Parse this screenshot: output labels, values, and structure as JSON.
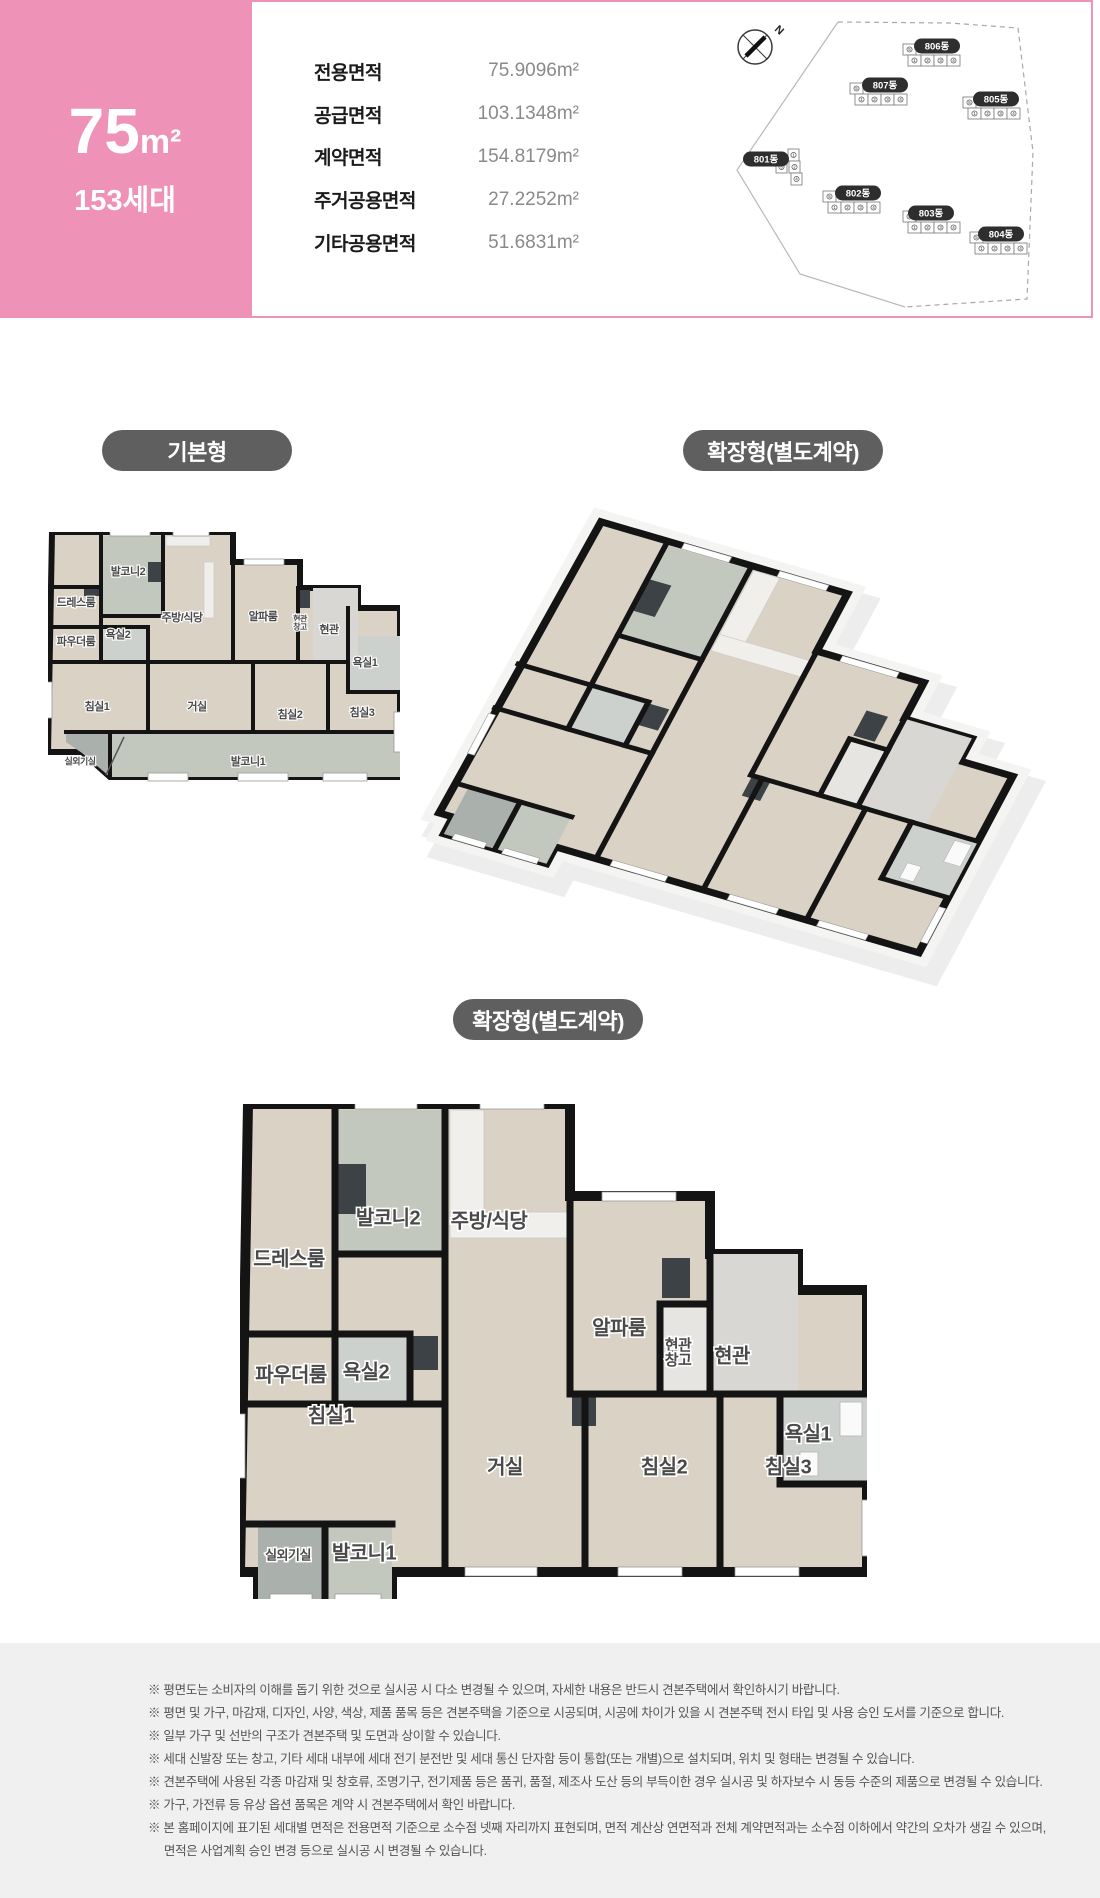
{
  "header": {
    "type_box": {
      "size": "75",
      "unit": "m²",
      "households": "153세대",
      "bg": "#ee92b8"
    },
    "area_table": {
      "rows": [
        {
          "label": "전용면적",
          "value": "75.9096m²"
        },
        {
          "label": "공급면적",
          "value": "103.1348m²"
        },
        {
          "label": "계약면적",
          "value": "154.8179m²"
        },
        {
          "label": "주거공용면적",
          "value": "27.2252m²"
        },
        {
          "label": "기타공용면적",
          "value": "51.6831m²"
        }
      ]
    },
    "site_plan": {
      "compass_label": "N",
      "pink": "#f19ec6",
      "unit_numbers": [
        "1",
        "2",
        "3",
        "4",
        "5"
      ],
      "buildings": [
        {
          "name": "806동",
          "bx": 937,
          "by": 44,
          "ux": 903,
          "uy": 52,
          "layout": "row",
          "pink": 2
        },
        {
          "name": "807동",
          "bx": 885,
          "by": 83,
          "ux": 850,
          "uy": 91,
          "layout": "row",
          "pink": -1
        },
        {
          "name": "805동",
          "bx": 996,
          "by": 97,
          "ux": 963,
          "uy": 105,
          "layout": "row",
          "pink": 2
        },
        {
          "name": "801동",
          "bx": 766,
          "by": 157,
          "ux": 788,
          "uy": 147,
          "layout": "col",
          "pink": -1
        },
        {
          "name": "802동",
          "bx": 858,
          "by": 191,
          "ux": 823,
          "uy": 199,
          "layout": "row",
          "pink": 2
        },
        {
          "name": "803동",
          "bx": 931,
          "by": 211,
          "ux": 903,
          "uy": 219,
          "layout": "row",
          "pink": -1
        },
        {
          "name": "804동",
          "bx": 1001,
          "by": 232,
          "ux": 970,
          "uy": 240,
          "layout": "row",
          "pink": 2
        }
      ]
    }
  },
  "plans": {
    "basic": {
      "badge": "기본형",
      "rooms": [
        {
          "n": "발코니2",
          "x": 80,
          "y": 40
        },
        {
          "n": "드레스룸",
          "x": 28,
          "y": 71
        },
        {
          "n": "파우더룸",
          "x": 28,
          "y": 110
        },
        {
          "n": "욕실2",
          "x": 70,
          "y": 103
        },
        {
          "n": "주방/식당",
          "x": 134,
          "y": 86
        },
        {
          "n": "알파룸",
          "x": 215,
          "y": 85
        },
        {
          "n": "현관\n창고",
          "x": 252,
          "y": 90,
          "fs": 8
        },
        {
          "n": "현관",
          "x": 281,
          "y": 98
        },
        {
          "n": "욕실1",
          "x": 317,
          "y": 131
        },
        {
          "n": "침실1",
          "x": 49,
          "y": 175
        },
        {
          "n": "거실",
          "x": 149,
          "y": 175
        },
        {
          "n": "침실2",
          "x": 242,
          "y": 183
        },
        {
          "n": "침실3",
          "x": 314,
          "y": 181
        },
        {
          "n": "실외기실",
          "x": 32,
          "y": 230,
          "fs": 9
        },
        {
          "n": "발코니1",
          "x": 200,
          "y": 230
        }
      ]
    },
    "extended_top": {
      "badge": "확장형(별도계약)"
    },
    "extended_bottom": {
      "badge": "확장형(별도계약)",
      "rooms": [
        {
          "n": "발코니2",
          "x": 148,
          "y": 115
        },
        {
          "n": "주방/식당",
          "x": 249,
          "y": 118
        },
        {
          "n": "드레스룸",
          "x": 49,
          "y": 156
        },
        {
          "n": "파우더룸",
          "x": 51,
          "y": 272
        },
        {
          "n": "욕실2",
          "x": 126,
          "y": 269
        },
        {
          "n": "알파룸",
          "x": 379,
          "y": 225
        },
        {
          "n": "현관\n창고",
          "x": 438,
          "y": 247,
          "fs": 15
        },
        {
          "n": "현관",
          "x": 492,
          "y": 253
        },
        {
          "n": "욕실1",
          "x": 568,
          "y": 331
        },
        {
          "n": "침실1",
          "x": 91,
          "y": 313
        },
        {
          "n": "거실",
          "x": 265,
          "y": 364
        },
        {
          "n": "침실2",
          "x": 424,
          "y": 364
        },
        {
          "n": "침실3",
          "x": 548,
          "y": 364
        },
        {
          "n": "실외기실",
          "x": 48,
          "y": 452,
          "fs": 13
        },
        {
          "n": "발코니1",
          "x": 124,
          "y": 450
        }
      ]
    }
  },
  "notices": [
    "※ 평면도는 소비자의 이해를 돕기 위한 것으로 실시공 시 다소 변경될 수 있으며, 자세한 내용은 반드시 견본주택에서 확인하시기 바랍니다.",
    "※ 평면 및 가구, 마감재, 디자인, 사양, 색상, 제품 품목 등은 견본주택을 기준으로 시공되며, 시공에 차이가 있을 시 견본주택 전시 타입 및 사용 승인 도서를 기준으로 합니다.",
    "※ 일부 가구 및 선반의 구조가 견본주택 및 도면과 상이할 수 있습니다.",
    "※ 세대 신발장 또는 창고, 기타 세대 내부에 세대 전기 분전반 및 세대 통신 단자함 등이 통합(또는 개별)으로 설치되며, 위치 및 형태는 변경될 수 있습니다.",
    "※ 견본주택에 사용된 각종 마감재 및 창호류, 조명기구, 전기제품 등은 품귀, 품절, 제조사 도산 등의 부득이한 경우 실시공 및 하자보수 시 동등 수준의 제품으로 변경될 수 있습니다.",
    "※ 가구, 가전류 등 유상 옵션 품목은 계약 시 견본주택에서 확인 바랍니다.",
    "※ 본 홈페이지에 표기된 세대별 면적은 전용면적 기준으로 소수점 넷째 자리까지 표현되며, 면적 계산상 연면적과 전체 계약면적과는 소수점 이하에서 약간의 오차가 생길 수 있으며,",
    "     면적은 사업계획 승인 변경 등으로 실시공 시 변경될 수 있습니다."
  ],
  "colors": {
    "pink": "#ee92b8",
    "badge": "#5f5f5f",
    "floor": "#d9d2c5",
    "tile": "#c3c8bf",
    "bath": "#cdd1ce",
    "entry": "#d8d7d3",
    "wall": "#141414",
    "notice_bg": "#f0f0f0",
    "notice_text": "#555555"
  }
}
